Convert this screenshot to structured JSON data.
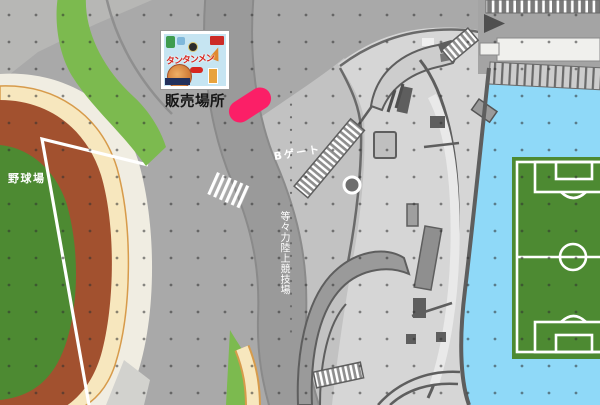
{
  "map": {
    "labels": {
      "sales_location": "販売場所",
      "gate_b": "Bゲート",
      "baseball_field": "野球場",
      "athletics_stadium": "等々力陸上競技場"
    },
    "poster": {
      "product_name": "タンタンメン"
    },
    "marker_color": "#FB1F67",
    "colors": {
      "road": "#A9A9A9",
      "plaza": "#C2C2C2",
      "stadium": "#D6D6D6",
      "water": "#8FD9F8",
      "pitch_green": "#4D8A32",
      "track_brown": "#A2512F",
      "path_tan": "#F7E7BE",
      "grass_green": "#7CBA4F",
      "cream": "#F0EDE2"
    }
  }
}
